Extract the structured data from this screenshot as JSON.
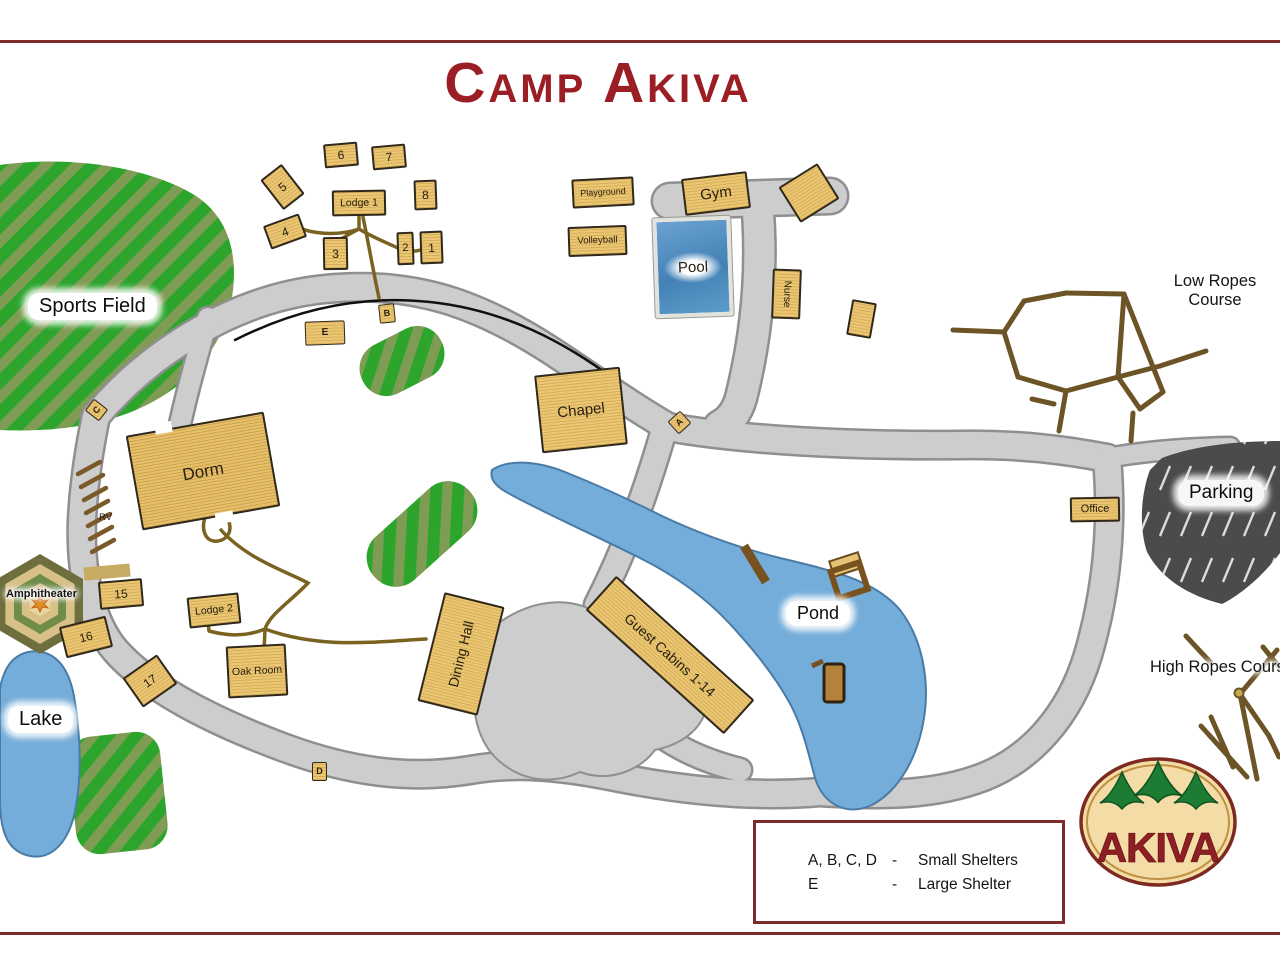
{
  "title": "Camp Akiva",
  "logo": {
    "text": "AKIVA"
  },
  "legend": {
    "rows": [
      {
        "keys": "A, B, C, D",
        "sep": "-",
        "desc": "Small Shelters"
      },
      {
        "keys": "E",
        "sep": "-",
        "desc": "Large Shelter"
      }
    ]
  },
  "labels": {
    "sports_field": "Sports Field",
    "low_ropes_line1": "Low Ropes",
    "low_ropes_line2": "Course",
    "high_ropes": "High Ropes Course",
    "parking": "Parking",
    "pond": "Pond",
    "lake": "Lake",
    "amphitheater": "Amphitheater",
    "rv": "RV"
  },
  "buildings": [
    {
      "id": "cabin-6",
      "label": "6",
      "x": 324,
      "y": 143,
      "w": 34,
      "h": 24,
      "rot": -5,
      "fs": 12
    },
    {
      "id": "cabin-7",
      "label": "7",
      "x": 372,
      "y": 145,
      "w": 34,
      "h": 24,
      "rot": -5,
      "fs": 12
    },
    {
      "id": "cabin-5",
      "label": "5",
      "x": 269,
      "y": 168,
      "w": 27,
      "h": 38,
      "rot": -38,
      "fs": 12
    },
    {
      "id": "lodge-1",
      "label": "Lodge 1",
      "x": 332,
      "y": 190,
      "w": 54,
      "h": 26,
      "rot": -1,
      "fs": 10.5
    },
    {
      "id": "cabin-8",
      "label": "8",
      "x": 414,
      "y": 180,
      "w": 23,
      "h": 30,
      "rot": -2,
      "fs": 12
    },
    {
      "id": "cabin-4",
      "label": "4",
      "x": 266,
      "y": 219,
      "w": 38,
      "h": 25,
      "rot": -20,
      "fs": 12
    },
    {
      "id": "cabin-3",
      "label": "3",
      "x": 323,
      "y": 237,
      "w": 25,
      "h": 33,
      "rot": -1,
      "fs": 12
    },
    {
      "id": "cabin-2",
      "label": "2",
      "x": 397,
      "y": 232,
      "w": 17,
      "h": 33,
      "rot": -2,
      "fs": 11
    },
    {
      "id": "cabin-1",
      "label": "1",
      "x": 420,
      "y": 231,
      "w": 23,
      "h": 33,
      "rot": -2,
      "fs": 12
    },
    {
      "id": "playground",
      "label": "Playground",
      "x": 572,
      "y": 178,
      "w": 62,
      "h": 29,
      "rot": -3,
      "fs": 9
    },
    {
      "id": "volleyball",
      "label": "Volleyball",
      "x": 568,
      "y": 226,
      "w": 59,
      "h": 30,
      "rot": -2,
      "fs": 9.5
    },
    {
      "id": "gym",
      "label": "Gym",
      "x": 683,
      "y": 175,
      "w": 66,
      "h": 37,
      "rot": -7,
      "fs": 15
    },
    {
      "id": "building-ne-of-gym",
      "label": "",
      "x": 786,
      "y": 172,
      "w": 46,
      "h": 42,
      "rot": -32
    },
    {
      "id": "nurse",
      "label": "Nurse",
      "x": 772,
      "y": 269,
      "w": 29,
      "h": 50,
      "rot": 2,
      "fs": 10,
      "labelRot": 90
    },
    {
      "id": "small-building",
      "label": "",
      "x": 849,
      "y": 301,
      "w": 25,
      "h": 36,
      "rot": 10
    },
    {
      "id": "shelter-e",
      "label": "E",
      "x": 305,
      "y": 321,
      "w": 40,
      "h": 24,
      "rot": -2,
      "fs": 10,
      "cls": "marker"
    },
    {
      "id": "shelter-b",
      "label": "B",
      "x": 379,
      "y": 304,
      "w": 16,
      "h": 19,
      "rot": -6,
      "fs": 9,
      "cls": "marker"
    },
    {
      "id": "shelter-c",
      "label": "C",
      "x": 89,
      "y": 401,
      "w": 15,
      "h": 18,
      "rot": -52,
      "fs": 9,
      "cls": "marker"
    },
    {
      "id": "shelter-a",
      "label": "A",
      "x": 671,
      "y": 414,
      "w": 17,
      "h": 17,
      "rot": -42,
      "fs": 9,
      "cls": "marker"
    },
    {
      "id": "shelter-d",
      "label": "D",
      "x": 312,
      "y": 762,
      "w": 15,
      "h": 19,
      "rot": 0,
      "fs": 9,
      "cls": "marker"
    },
    {
      "id": "chapel",
      "label": "Chapel",
      "x": 538,
      "y": 371,
      "w": 86,
      "h": 78,
      "rot": -6,
      "fs": 15
    },
    {
      "id": "dorm",
      "label": "Dorm",
      "x": 133,
      "y": 423,
      "w": 140,
      "h": 96,
      "rot": -10,
      "fs": 17,
      "cls": "dorm"
    },
    {
      "id": "office",
      "label": "Office",
      "x": 1070,
      "y": 497,
      "w": 50,
      "h": 25,
      "rot": -1,
      "fs": 11
    },
    {
      "id": "cabin-15",
      "label": "15",
      "x": 99,
      "y": 580,
      "w": 44,
      "h": 28,
      "rot": -5,
      "fs": 12
    },
    {
      "id": "cabin-16",
      "label": "16",
      "x": 62,
      "y": 621,
      "w": 48,
      "h": 32,
      "rot": -14,
      "fs": 12
    },
    {
      "id": "cabin-17",
      "label": "17",
      "x": 129,
      "y": 663,
      "w": 42,
      "h": 36,
      "rot": -35,
      "fs": 12
    },
    {
      "id": "lodge-2",
      "label": "Lodge 2",
      "x": 188,
      "y": 595,
      "w": 52,
      "h": 31,
      "rot": -6,
      "fs": 10.5
    },
    {
      "id": "oak-room",
      "label": "Oak Room",
      "x": 227,
      "y": 645,
      "w": 60,
      "h": 52,
      "rot": -3,
      "fs": 10.5
    },
    {
      "id": "dining-hall",
      "label": "Dining Hall",
      "x": 430,
      "y": 598,
      "w": 62,
      "h": 112,
      "rot": 14,
      "fs": 14,
      "labelRot": -90
    },
    {
      "id": "guest-cabins-1-14",
      "label": "Guest Cabins 1-14",
      "x": 577,
      "y": 632,
      "w": 186,
      "h": 46,
      "rot": 42,
      "fs": 14
    },
    {
      "id": "pool",
      "label": "Pool",
      "x": 654,
      "y": 217,
      "w": 78,
      "h": 100,
      "rot": -2,
      "fs": 15,
      "cls": "pool"
    }
  ]
}
